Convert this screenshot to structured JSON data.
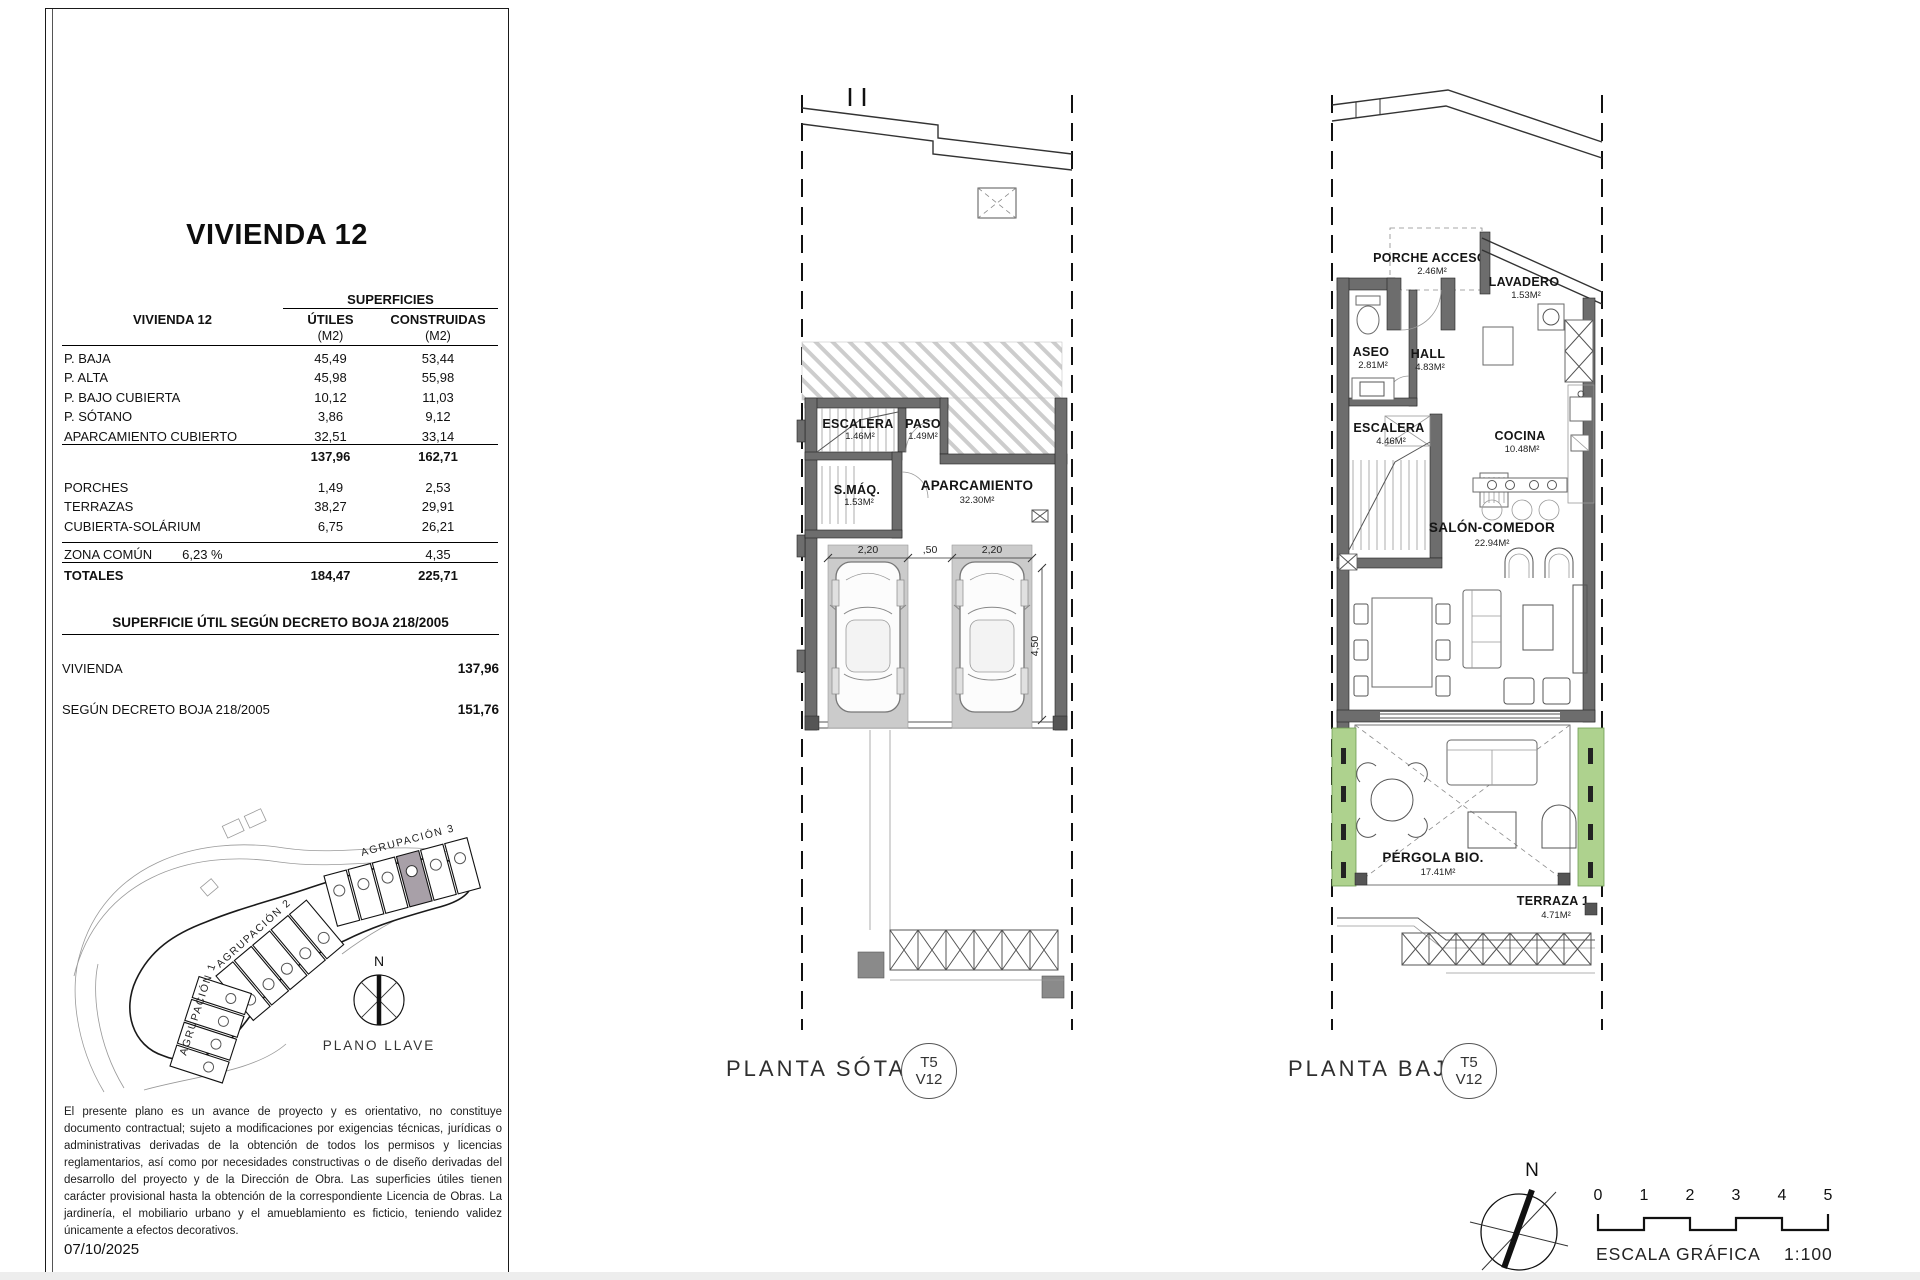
{
  "sheet": {
    "title": "VIVIENDA 12",
    "date": "07/10/2025",
    "disclaimer": "El presente plano es un avance de proyecto y es orientativo, no constituye documento contractual; sujeto a modificaciones por exigencias técnicas, jurídicas o administrativas derivadas de la obtención de todos los permisos y licencias reglamentarios, así como por necesidades constructivas o de diseño derivadas del desarrollo del proyecto y de la Dirección de Obra. Las superficies útiles tienen carácter provisional hasta la obtención de la correspondiente Licencia de Obras. La jardinería, el mobiliario urbano y el amueblamiento es ficticio, teniendo validez únicamente a efectos decorativos."
  },
  "surfaces_table": {
    "row_header": "VIVIENDA 12",
    "group_header": "SUPERFICIES",
    "col_utiles": "ÚTILES",
    "col_construidas": "CONSTRUIDAS",
    "unit_label": "(M2)",
    "rows": [
      {
        "label": "P. BAJA",
        "utiles": "45,49",
        "construidas": "53,44"
      },
      {
        "label": "P. ALTA",
        "utiles": "45,98",
        "construidas": "55,98"
      },
      {
        "label": "P. BAJO CUBIERTA",
        "utiles": "10,12",
        "construidas": "11,03"
      },
      {
        "label": "P. SÓTANO",
        "utiles": "3,86",
        "construidas": "9,12"
      },
      {
        "label": "APARCAMIENTO CUBIERTO",
        "utiles": "32,51",
        "construidas": "33,14"
      }
    ],
    "subtotal": {
      "utiles": "137,96",
      "construidas": "162,71"
    },
    "extra_rows": [
      {
        "label": "PORCHES",
        "utiles": "1,49",
        "construidas": "2,53"
      },
      {
        "label": "TERRAZAS",
        "utiles": "38,27",
        "construidas": "29,91"
      },
      {
        "label": "CUBIERTA-SOLÁRIUM",
        "utiles": "6,75",
        "construidas": "26,21"
      }
    ],
    "zona_comun": {
      "label": "ZONA COMÚN",
      "pct": "6,23 %",
      "construidas": "4,35"
    },
    "totales": {
      "label": "TOTALES",
      "utiles": "184,47",
      "construidas": "225,71"
    }
  },
  "decreto": {
    "title": "SUPERFICIE ÚTIL SEGÚN DECRETO BOJA 218/2005",
    "rows": [
      {
        "label": "VIVIENDA",
        "value": "137,96"
      },
      {
        "label": "SEGÚN DECRETO BOJA 218/2005",
        "value": "151,76"
      }
    ]
  },
  "site_plan": {
    "labels": {
      "agrupacion_1": "AGRUPACIÓN 1",
      "agrupacion_2": "AGRUPACIÓN 2",
      "agrupacion_3": "AGRUPACIÓN 3"
    },
    "north": "N",
    "caption": "PLANO LLAVE"
  },
  "sotano": {
    "title": "PLANTA SÓTANO",
    "badge": {
      "type": "T5",
      "unit": "V12"
    },
    "rooms": {
      "escalera": {
        "name": "ESCALERA",
        "area": "1.46M²"
      },
      "paso": {
        "name": "PASO",
        "area": "1.49M²"
      },
      "smaq": {
        "name": "S.MÁQ.",
        "area": "1.53M²"
      },
      "aparcamiento": {
        "name": "APARCAMIENTO",
        "area": "32.30M²"
      }
    },
    "dims": {
      "left": "2,20",
      "mid": ",50",
      "right": "2,20",
      "depth": "4,50"
    }
  },
  "baja": {
    "title": "PLANTA BAJA",
    "badge": {
      "type": "T5",
      "unit": "V12"
    },
    "rooms": {
      "porche": {
        "name": "PORCHE ACCESO",
        "area": "2.46M²"
      },
      "lavadero": {
        "name": "LAVADERO",
        "area": "1.53M²"
      },
      "aseo": {
        "name": "ASEO",
        "area": "2.81M²"
      },
      "hall": {
        "name": "HALL",
        "area": "4.83M²"
      },
      "escalera": {
        "name": "ESCALERA",
        "area": "4.46M²"
      },
      "cocina": {
        "name": "COCINA",
        "area": "10.48M²"
      },
      "salon": {
        "name": "SALÓN-COMEDOR",
        "area": "22.94M²"
      },
      "pergola": {
        "name": "PÉRGOLA BIO.",
        "area": "17.41M²"
      },
      "terraza": {
        "name": "TERRAZA 1",
        "area": "4.71M²"
      }
    }
  },
  "scale_bar": {
    "ticks": [
      "0",
      "1",
      "2",
      "3",
      "4",
      "5"
    ],
    "caption": "ESCALA GRÁFICA",
    "ratio": "1:100",
    "north": "N"
  },
  "colors": {
    "wall": "#6d6d6d",
    "parking": "#cbcbcb",
    "green": "#aed28e",
    "highlight": "#a8a0a8",
    "line": "#111111"
  }
}
